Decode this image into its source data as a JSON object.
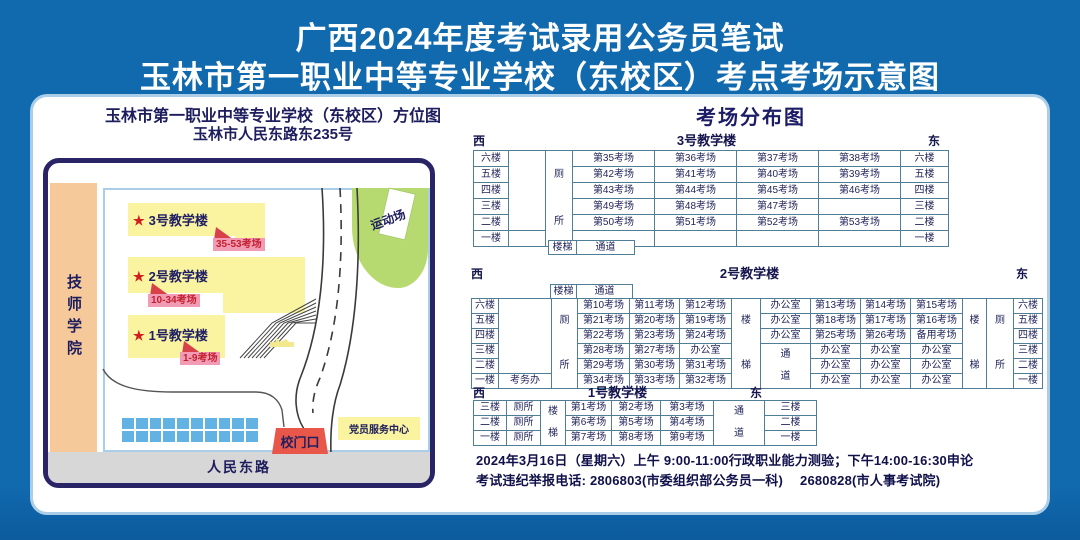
{
  "banner": {
    "line1": "广西2024年度考试录用公务员笔试",
    "line2": "玉林市第一职业中等专业学校（东校区）考点考场示意图"
  },
  "map_panel": {
    "title": "玉林市第一职业中等专业学校（东校区）方位图",
    "subtitle": "玉林市人民东路东235号",
    "neighbor": "技师学院",
    "buildings": [
      {
        "star": "★",
        "name": "3号教学楼",
        "rooms_label": "35-53考场"
      },
      {
        "star": "★",
        "name": "2号教学楼",
        "rooms_label": "10-34考场"
      },
      {
        "star": "★",
        "name": "1号教学楼",
        "rooms_label": "1-9考场"
      }
    ],
    "sports_field": "运动场",
    "gate": "校门口",
    "party_center": "党员服务中心",
    "main_road": "人民东路"
  },
  "distribution": {
    "title": "考场分布图",
    "tables": [
      {
        "name": "3号教学楼",
        "west": "西",
        "east": "东",
        "stairs": "楼梯",
        "passage": "通道",
        "matrix": [
          [
            {
              "t": "六楼",
              "w": 34
            },
            {
              "t": "",
              "w": 36,
              "r": 5
            },
            {
              "t": "厕所",
              "w": 26,
              "r": 6,
              "v": 1
            },
            {
              "t": "第35考场",
              "w": 81
            },
            {
              "t": "第36考场",
              "w": 81
            },
            {
              "t": "第37考场",
              "w": 81
            },
            {
              "t": "第38考场",
              "w": 81
            },
            {
              "t": "六楼",
              "w": 47
            }
          ],
          [
            {
              "t": "五楼"
            },
            {
              "t": "第42考场"
            },
            {
              "t": "第41考场"
            },
            {
              "t": "第40考场"
            },
            {
              "t": "第39考场"
            },
            {
              "t": "五楼"
            }
          ],
          [
            {
              "t": "四楼"
            },
            {
              "t": "第43考场"
            },
            {
              "t": "第44考场"
            },
            {
              "t": "第45考场"
            },
            {
              "t": "第46考场"
            },
            {
              "t": "四楼"
            }
          ],
          [
            {
              "t": "三楼"
            },
            {
              "t": "第49考场"
            },
            {
              "t": "第48考场"
            },
            {
              "t": "第47考场"
            },
            {
              "t": ""
            },
            {
              "t": "三楼"
            }
          ],
          [
            {
              "t": "二楼"
            },
            {
              "t": "第50考场"
            },
            {
              "t": "第51考场"
            },
            {
              "t": "第52考场"
            },
            {
              "t": "第53考场"
            },
            {
              "t": "二楼"
            }
          ],
          [
            {
              "t": "一楼"
            },
            {
              "t": "",
              "w": 36
            },
            {
              "t": ""
            },
            {
              "t": ""
            },
            {
              "t": ""
            },
            {
              "t": ""
            },
            {
              "t": "一楼"
            }
          ]
        ]
      },
      {
        "name": "2号教学楼",
        "west": "西",
        "east": "东",
        "stairs": "楼梯",
        "passage": "通道",
        "matrix": [
          [
            {
              "t": "六楼",
              "w": 26
            },
            {
              "t": "",
              "w": 52,
              "r": 5
            },
            {
              "t": "厕所",
              "w": 25,
              "r": 6,
              "v": 1
            },
            {
              "t": "第10考场",
              "w": 51
            },
            {
              "t": "第11考场",
              "w": 49
            },
            {
              "t": "第12考场",
              "w": 51
            },
            {
              "t": "楼梯",
              "w": 28,
              "r": 6,
              "v": 1
            },
            {
              "t": "办公室",
              "w": 49
            },
            {
              "t": "第13考场",
              "w": 49
            },
            {
              "t": "第14考场",
              "w": 49
            },
            {
              "t": "第15考场",
              "w": 51
            },
            {
              "t": "楼梯",
              "w": 23,
              "r": 6,
              "v": 1
            },
            {
              "t": "厕所",
              "w": 26,
              "r": 6,
              "v": 1
            },
            {
              "t": "六楼",
              "w": 28
            }
          ],
          [
            {
              "t": "五楼"
            },
            {
              "t": "第21考场"
            },
            {
              "t": "第20考场"
            },
            {
              "t": "第19考场"
            },
            {
              "t": "办公室"
            },
            {
              "t": "第18考场"
            },
            {
              "t": "第17考场"
            },
            {
              "t": "第16考场"
            },
            {
              "t": "五楼"
            }
          ],
          [
            {
              "t": "四楼"
            },
            {
              "t": "第22考场"
            },
            {
              "t": "第23考场"
            },
            {
              "t": "第24考场"
            },
            {
              "t": "办公室"
            },
            {
              "t": "第25考场"
            },
            {
              "t": "第26考场"
            },
            {
              "t": "备用考场"
            },
            {
              "t": "四楼"
            }
          ],
          [
            {
              "t": "三楼"
            },
            {
              "t": "第28考场"
            },
            {
              "t": "第27考场"
            },
            {
              "t": "办公室"
            },
            {
              "t": "通道",
              "r": 3,
              "v": 1
            },
            {
              "t": "办公室"
            },
            {
              "t": "办公室"
            },
            {
              "t": "办公室"
            },
            {
              "t": "三楼"
            }
          ],
          [
            {
              "t": "二楼"
            },
            {
              "t": "第29考场"
            },
            {
              "t": "第30考场"
            },
            {
              "t": "第31考场"
            },
            {
              "t": "办公室"
            },
            {
              "t": "办公室"
            },
            {
              "t": "办公室"
            },
            {
              "t": "二楼"
            }
          ],
          [
            {
              "t": "一楼"
            },
            {
              "t": "考务办",
              "w": 52
            },
            {
              "t": "第34考场"
            },
            {
              "t": "第33考场"
            },
            {
              "t": "第32考场"
            },
            {
              "t": "办公室"
            },
            {
              "t": "办公室"
            },
            {
              "t": "办公室"
            },
            {
              "t": "一楼"
            }
          ]
        ]
      },
      {
        "name": "1号教学楼",
        "west": "西",
        "east": "东",
        "stairs": "楼梯",
        "passage": "通道",
        "matrix": [
          [
            {
              "t": "三楼",
              "w": 32
            },
            {
              "t": "厕所",
              "w": 33
            },
            {
              "t": "楼梯",
              "w": 24,
              "r": 3,
              "v": 1
            },
            {
              "t": "第1考场",
              "w": 45
            },
            {
              "t": "第2考场",
              "w": 48
            },
            {
              "t": "第3考场",
              "w": 52
            },
            {
              "t": "通道",
              "w": 50,
              "r": 3,
              "v": 1
            },
            {
              "t": "三楼",
              "w": 51
            }
          ],
          [
            {
              "t": "二楼"
            },
            {
              "t": "厕所"
            },
            {
              "t": "第6考场"
            },
            {
              "t": "第5考场"
            },
            {
              "t": "第4考场"
            },
            {
              "t": "二楼"
            }
          ],
          [
            {
              "t": "一楼"
            },
            {
              "t": "厕所"
            },
            {
              "t": "第7考场"
            },
            {
              "t": "第8考场"
            },
            {
              "t": "第9考场"
            },
            {
              "t": "一楼"
            }
          ]
        ]
      }
    ]
  },
  "footer": {
    "line1": "2024年3月16日（星期六）上午 9:00-11:00行政职业能力测验；下午14:00-16:30申论",
    "line2": "考试违纪举报电话: 2806803(市委组织部公务员一科)　 2680828(市人事考试院)"
  }
}
